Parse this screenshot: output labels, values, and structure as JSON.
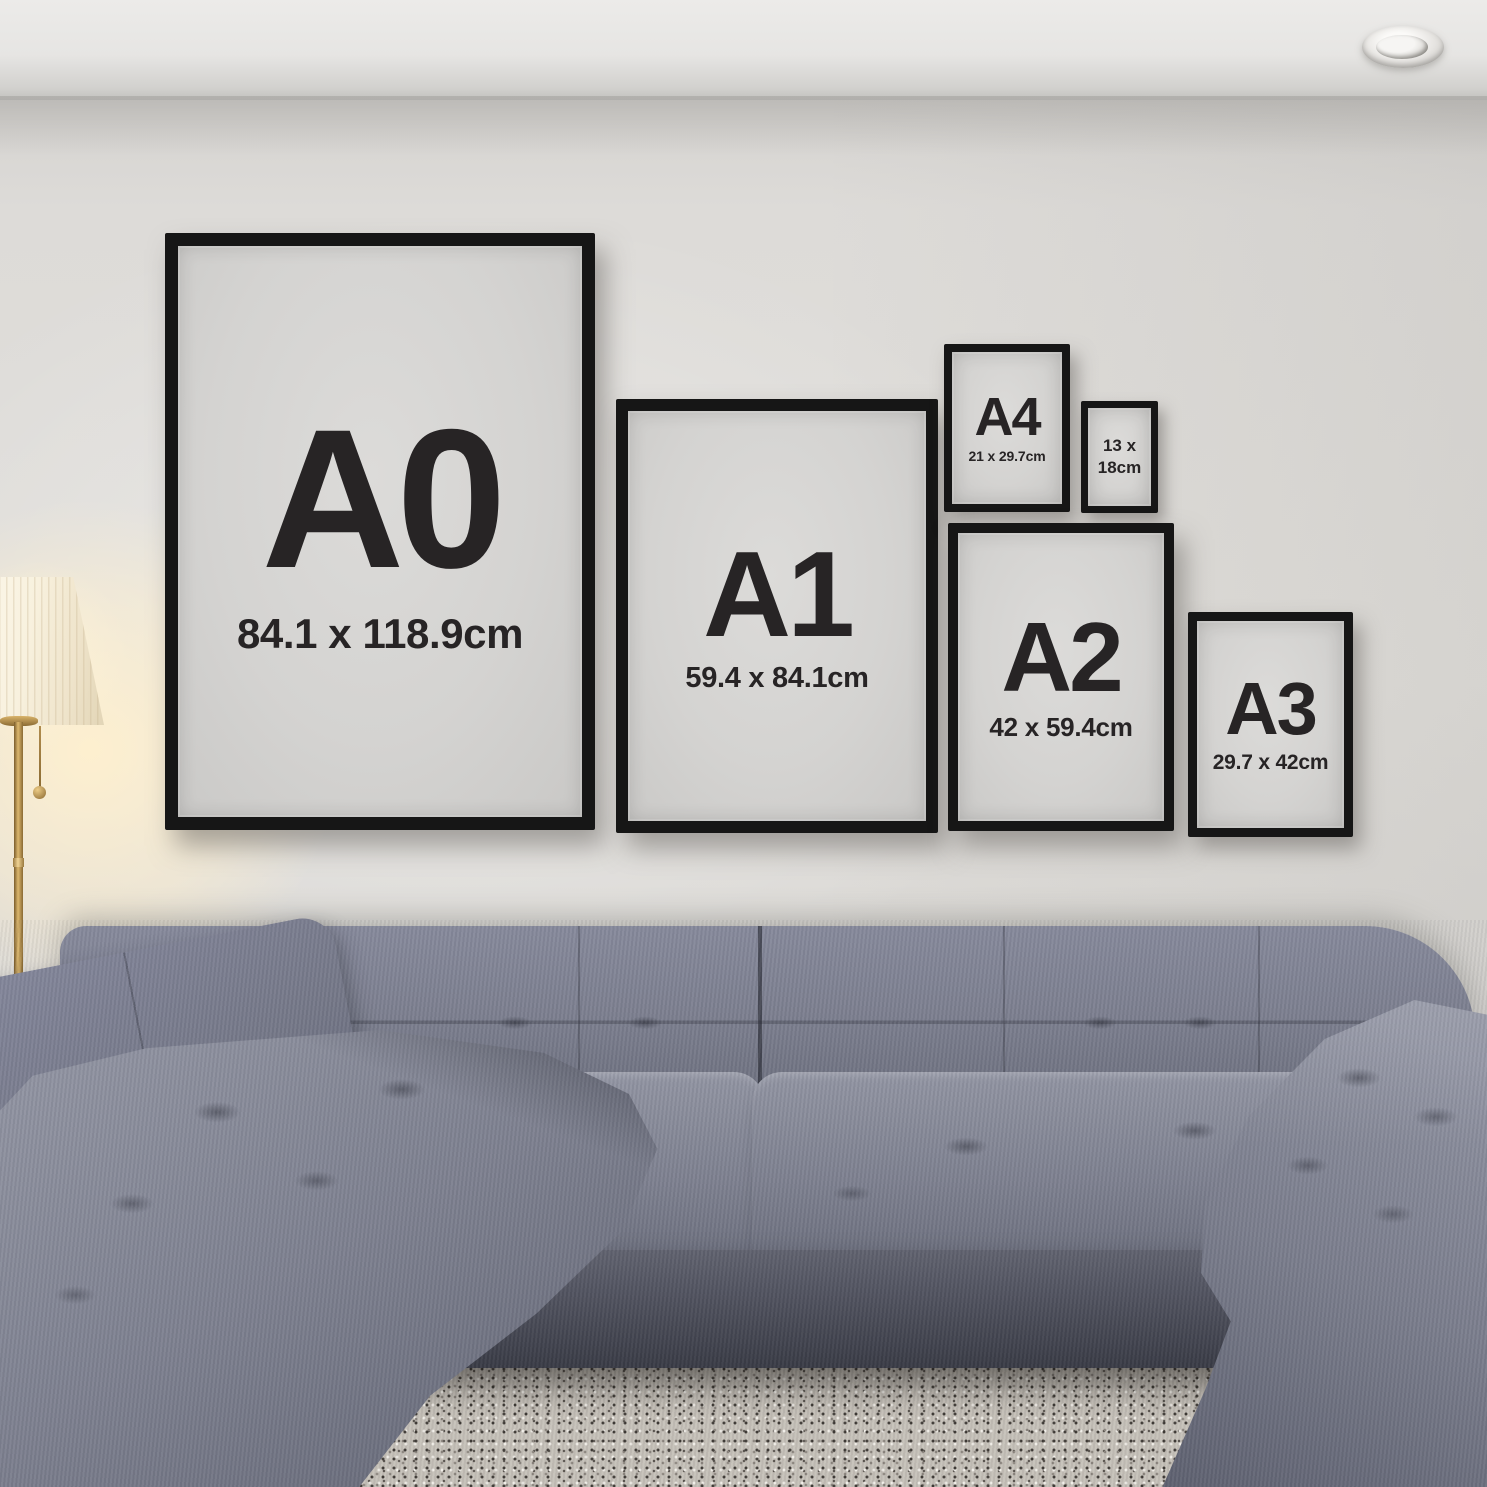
{
  "frames": {
    "a0": {
      "code": "A0",
      "dims": "84.1 x 118.9cm"
    },
    "a1": {
      "code": "A1",
      "dims": "59.4 x 84.1cm"
    },
    "a4": {
      "code": "A4",
      "dims": "21 x 29.7cm"
    },
    "f13x18": {
      "dims_line1": "13 x",
      "dims_line2": "18cm"
    },
    "a2": {
      "code": "A2",
      "dims": "42 x 59.4cm"
    },
    "a3": {
      "code": "A3",
      "dims": "29.7 x 42cm"
    }
  },
  "colors": {
    "frame_border": "#161616",
    "frame_mat": "#d4d3d1",
    "frame_text": "#272425",
    "wall": "#dddbd8",
    "ceiling": "#ecebe9",
    "sofa_fabric": "#7d8090",
    "sofa_shadow": "#4a4c58",
    "carpet": "#c6c1b9",
    "floor": "#4a3a30",
    "lamp_shade": "#f8f1de",
    "lamp_brass": "#c09a58",
    "lamp_glow": "#fff0ce"
  }
}
